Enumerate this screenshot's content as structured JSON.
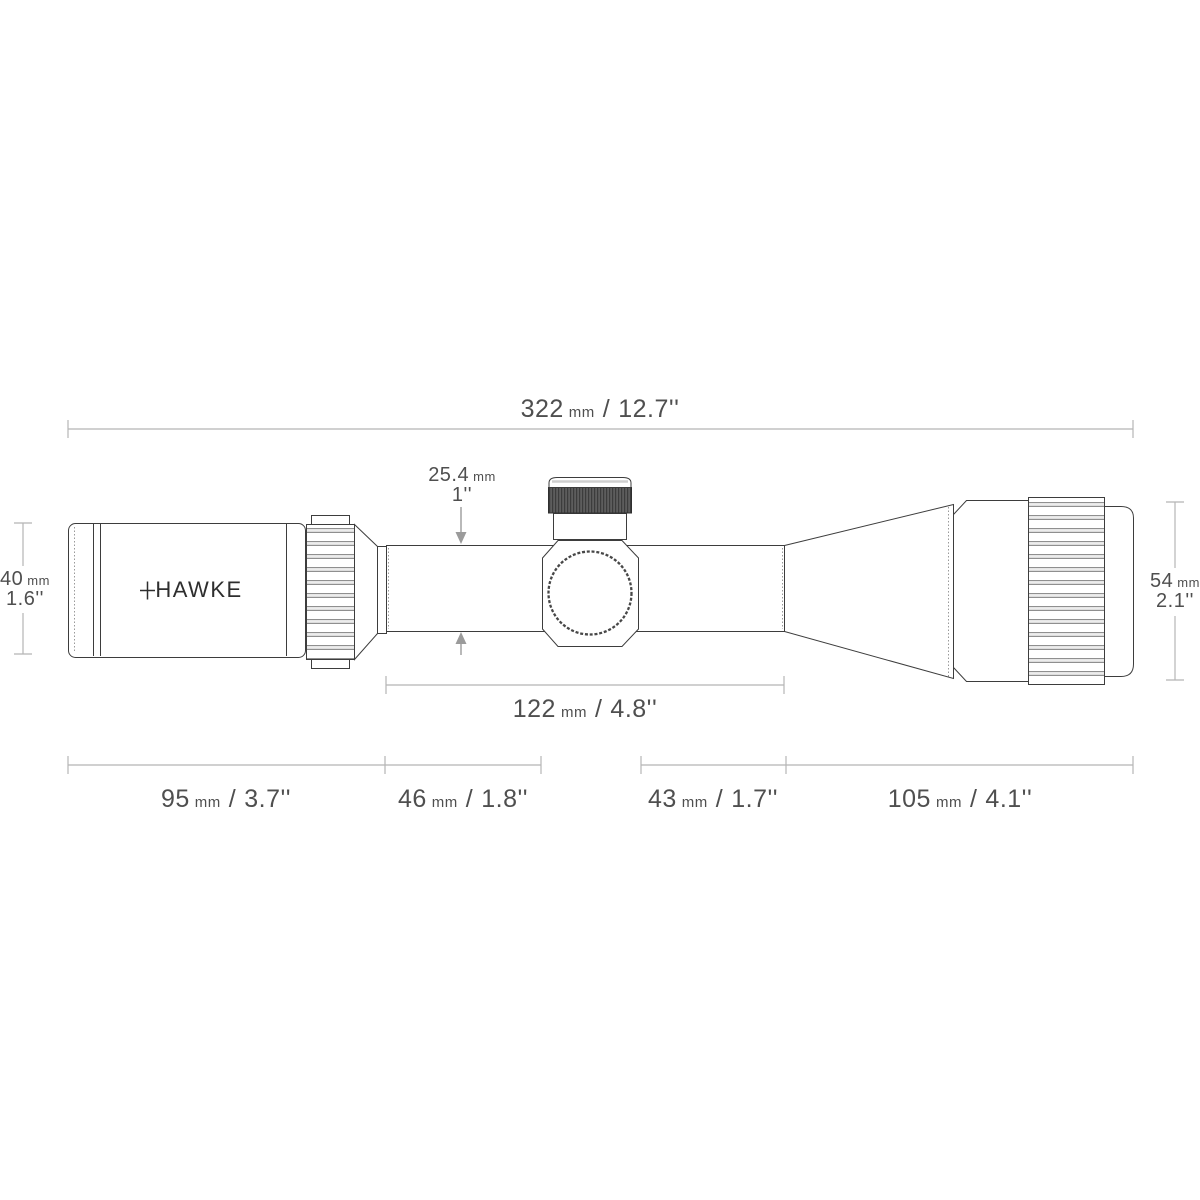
{
  "brand": {
    "name": "HAWKE"
  },
  "separator": "/",
  "colors": {
    "outline": "#3d3d3d",
    "dimension_line": "#b5b5b5",
    "label_text": "#4f4f4f",
    "arrow": "#9b9b9b",
    "turret_knurl": "#555555",
    "background": "#ffffff"
  },
  "dimensions": {
    "total_length": {
      "value": "322",
      "unit": "mm",
      "imperial": "12.7''"
    },
    "tube_diameter": {
      "value": "25.4",
      "unit": "mm",
      "imperial": "1''"
    },
    "ocular_diameter": {
      "value": "40",
      "unit": "mm",
      "imperial": "1.6''"
    },
    "objective_diameter": {
      "value": "54",
      "unit": "mm",
      "imperial": "2.1''"
    },
    "mount_tube_length": {
      "value": "122",
      "unit": "mm",
      "imperial": "4.8''"
    },
    "ocular_assembly_length": {
      "value": "95",
      "unit": "mm",
      "imperial": "3.7''"
    },
    "rear_tube_length": {
      "value": "46",
      "unit": "mm",
      "imperial": "1.8''"
    },
    "front_tube_length": {
      "value": "43",
      "unit": "mm",
      "imperial": "1.7''"
    },
    "objective_assembly_length": {
      "value": "105",
      "unit": "mm",
      "imperial": "4.1''"
    }
  }
}
